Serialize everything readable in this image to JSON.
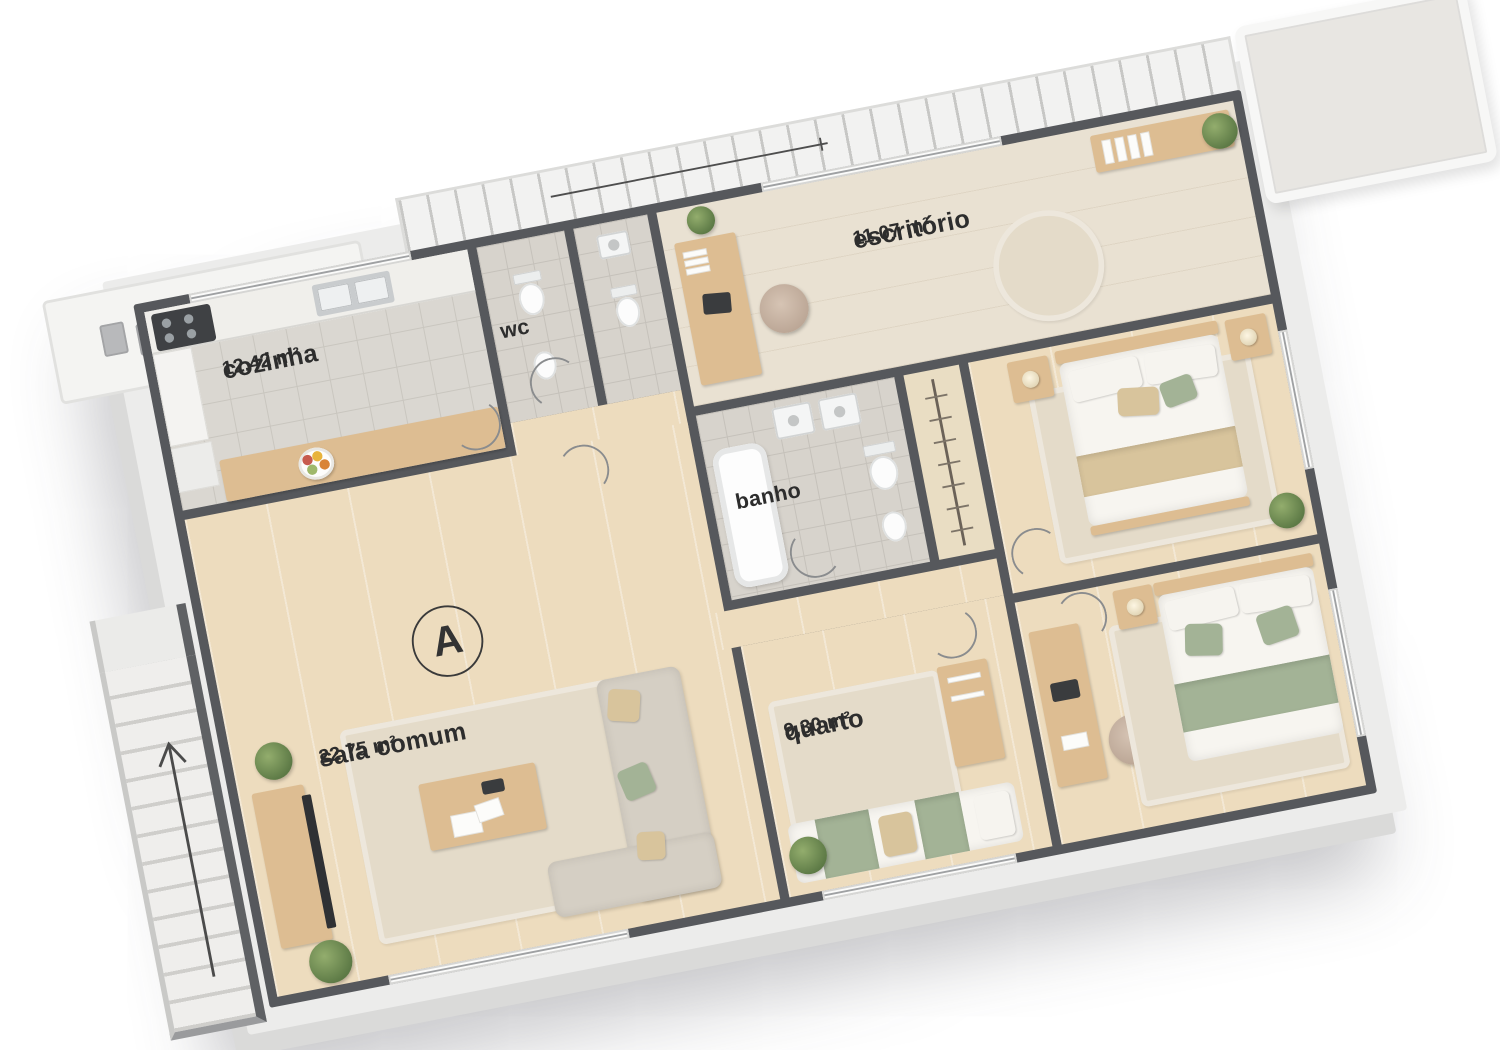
{
  "floor_plan": {
    "unit_marker": "A",
    "rooms": [
      {
        "id": "cozinha",
        "label": "cozinha",
        "area": "12,42 m²"
      },
      {
        "id": "wc",
        "label": "wc",
        "area": ""
      },
      {
        "id": "escritorio",
        "label": "escritório",
        "area": "11,07 m²"
      },
      {
        "id": "banho",
        "label": "banho",
        "area": ""
      },
      {
        "id": "sala-comum",
        "label": "sala comum",
        "area": "22,75 m²"
      },
      {
        "id": "quarto",
        "label": "quarto",
        "area": "9,30 m²"
      }
    ],
    "colors": {
      "wall": "#56585c",
      "wood_floor": "#eddcbe",
      "pale_wood_floor": "#e9e1d2",
      "kitchen_tile": "#dad7d1",
      "bath_tile": "#d7d3cc",
      "rug": "#e4dbc9",
      "sofa": "#d5cfc4",
      "furniture_wood": "#ddbd92",
      "accent_green": "#a3b396",
      "accent_tan": "#d8c49c",
      "label_text": "#2d2d2d",
      "slab": "#ececeb",
      "balcony": "#f2f2f1"
    }
  }
}
